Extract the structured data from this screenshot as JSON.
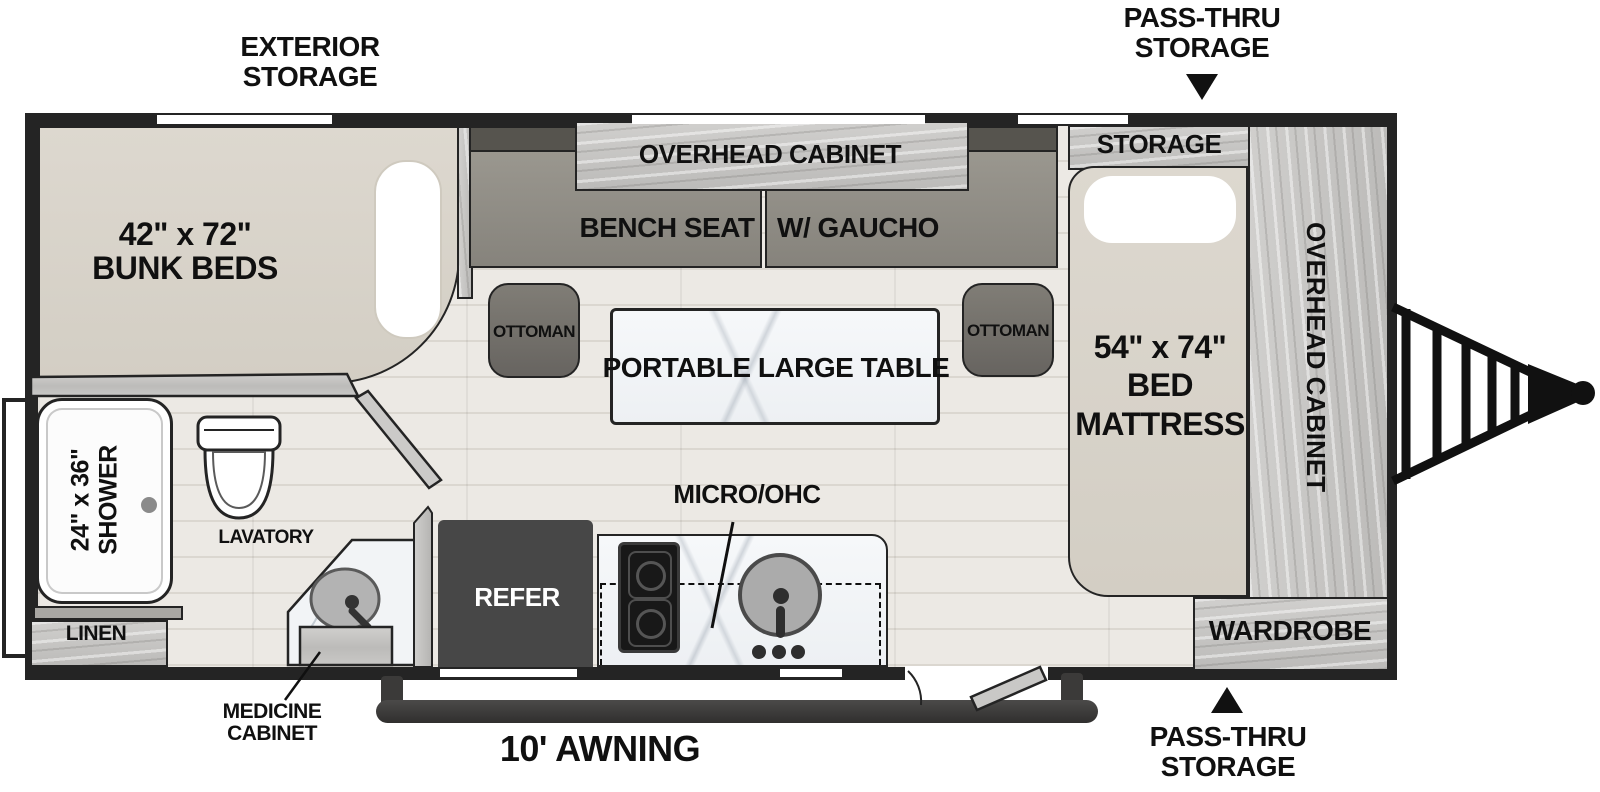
{
  "colors": {
    "wall": "#242424",
    "ink": "#101010",
    "mattress": "#d8d3c9",
    "seat": "#8f8c85",
    "seat_back": "#56544e",
    "ottoman": "#73706a",
    "wood": "#c7c5c2",
    "wood_dark": "#aeacaa",
    "marble": "#f4f6f8",
    "floor": "#ece9e4",
    "floor_line": "#dbd7d0",
    "refer": "#474747",
    "stove": "#181818",
    "metal": "#a8a8a8",
    "white": "#ffffff"
  },
  "callouts": {
    "exterior_storage": [
      "EXTERIOR",
      "STORAGE"
    ],
    "pass_thru_top": [
      "PASS-THRU",
      "STORAGE"
    ],
    "pass_thru_bottom": [
      "PASS-THRU",
      "STORAGE"
    ],
    "awning": "10' AWNING",
    "medicine_cabinet": [
      "MEDICINE",
      "CABINET"
    ]
  },
  "labels": {
    "bunk": [
      "42\" x 72\"",
      "BUNK BEDS"
    ],
    "bed": [
      "54\" x 74\"",
      "BED",
      "MATTRESS"
    ],
    "shower": [
      "24\" x 36\"",
      "SHOWER"
    ],
    "storage": "STORAGE",
    "overhead_cabinet": "OVERHEAD CABINET",
    "overhead_cabinet_side": "OVERHEAD CABINET",
    "bench_seat": "BENCH SEAT",
    "gaucho": "W/ GAUCHO",
    "ottoman_left": "OTTOMAN",
    "ottoman_right": "OTTOMAN",
    "table": "PORTABLE LARGE TABLE",
    "wardrobe": "WARDROBE",
    "linen": "LINEN",
    "lavatory": "LAVATORY",
    "refer": "REFER",
    "micro_ohc": "MICRO/OHC"
  }
}
